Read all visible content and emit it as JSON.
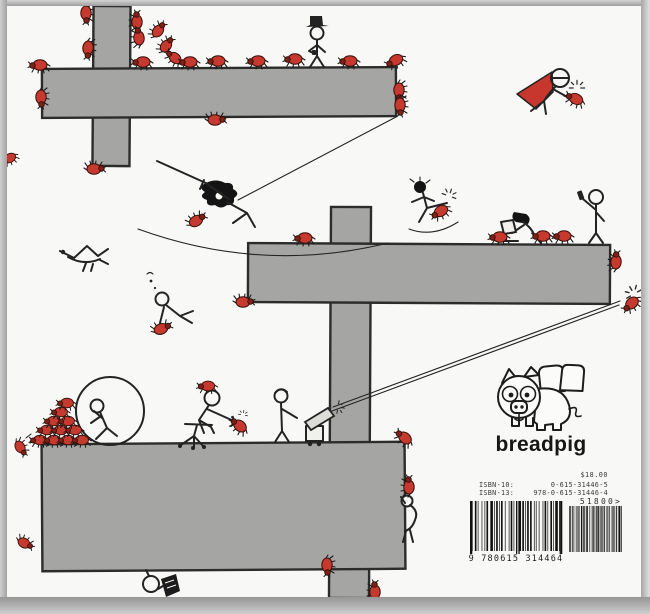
{
  "publisher": {
    "logo_text": "breadpig",
    "price": "$18.00",
    "isbn10_label": "ISBN-10:",
    "isbn10_value": "0-615-31446-5",
    "isbn13_label": "ISBN-13:",
    "isbn13_value": "978-0-615-31446-4",
    "price_code": "51800>",
    "barcode_digits": "9 780615 314464"
  },
  "colors": {
    "paper": "#f8f8f6",
    "ink": "#232323",
    "platform_gray": "#a5a5a3",
    "bug_red": "#c6392f",
    "cape_red": "#c8372d"
  },
  "scene": {
    "platforms": [
      {
        "name": "upper-column",
        "x": 93,
        "y": 6,
        "w": 37,
        "h": 160,
        "tilt": 0.4
      },
      {
        "name": "upper-deck",
        "x": 42,
        "y": 68,
        "w": 354,
        "h": 49,
        "tilt": -0.3
      },
      {
        "name": "central-column",
        "x": 330,
        "y": 207,
        "w": 40,
        "h": 391,
        "tilt": 0.3
      },
      {
        "name": "middle-deck",
        "x": 248,
        "y": 244,
        "w": 362,
        "h": 59,
        "tilt": 0.3
      },
      {
        "name": "lower-deck",
        "x": 42,
        "y": 443,
        "w": 363,
        "h": 127,
        "tilt": -0.4
      }
    ],
    "figures": [
      "hat-man",
      "caped-hero",
      "swinging-samurai",
      "kicking-fighter",
      "laptop-girl",
      "phone-man",
      "flying-bird",
      "falling-puncher",
      "hamster-ball-runner",
      "chair-jouster",
      "cannon-crew",
      "book-reader",
      "edge-climber"
    ],
    "bugs": [
      [
        86,
        13,
        -90,
        1
      ],
      [
        88,
        48,
        -85,
        1
      ],
      [
        137,
        22,
        90,
        1
      ],
      [
        139,
        38,
        85,
        1
      ],
      [
        158,
        31,
        130,
        0.95
      ],
      [
        166,
        46,
        130,
        0.95
      ],
      [
        175,
        58,
        40,
        0.95
      ],
      [
        143,
        62,
        0,
        1
      ],
      [
        190,
        62,
        0,
        1
      ],
      [
        218,
        61,
        0,
        1
      ],
      [
        258,
        61,
        0,
        1
      ],
      [
        295,
        59,
        0,
        1
      ],
      [
        350,
        61,
        0,
        1
      ],
      [
        396,
        60,
        -25,
        1
      ],
      [
        399,
        90,
        -90,
        1
      ],
      [
        400,
        105,
        -90,
        1
      ],
      [
        40,
        65,
        0,
        1
      ],
      [
        41,
        97,
        -90,
        1
      ],
      [
        94,
        169,
        180,
        1
      ],
      [
        215,
        120,
        180,
        1
      ],
      [
        10,
        158,
        -30,
        0.85
      ],
      [
        196,
        221,
        150,
        1
      ],
      [
        305,
        238,
        0,
        1
      ],
      [
        243,
        302,
        180,
        1
      ],
      [
        441,
        211,
        -30,
        1
      ],
      [
        500,
        237,
        0,
        1
      ],
      [
        543,
        236,
        0,
        1
      ],
      [
        564,
        236,
        0,
        1
      ],
      [
        616,
        262,
        95,
        1
      ],
      [
        632,
        303,
        -40,
        1
      ],
      [
        576,
        99,
        25,
        1
      ],
      [
        161,
        329,
        160,
        1
      ],
      [
        40,
        440,
        0,
        0.92
      ],
      [
        54,
        440,
        0,
        0.92
      ],
      [
        68,
        440,
        0,
        0.92
      ],
      [
        82,
        440,
        0,
        0.92
      ],
      [
        47,
        430,
        0,
        0.92
      ],
      [
        61,
        430,
        0,
        0.92
      ],
      [
        75,
        430,
        0,
        0.92
      ],
      [
        54,
        421,
        0,
        0.92
      ],
      [
        68,
        421,
        0,
        0.92
      ],
      [
        61,
        412,
        0,
        0.92
      ],
      [
        67,
        403,
        0,
        0.92
      ],
      [
        20,
        447,
        -120,
        0.9
      ],
      [
        208,
        386,
        0,
        0.95
      ],
      [
        240,
        426,
        40,
        1
      ],
      [
        405,
        438,
        40,
        1
      ],
      [
        409,
        487,
        90,
        1
      ],
      [
        327,
        565,
        -90,
        1
      ],
      [
        375,
        592,
        90,
        1
      ],
      [
        24,
        543,
        -150,
        0.9
      ]
    ]
  }
}
